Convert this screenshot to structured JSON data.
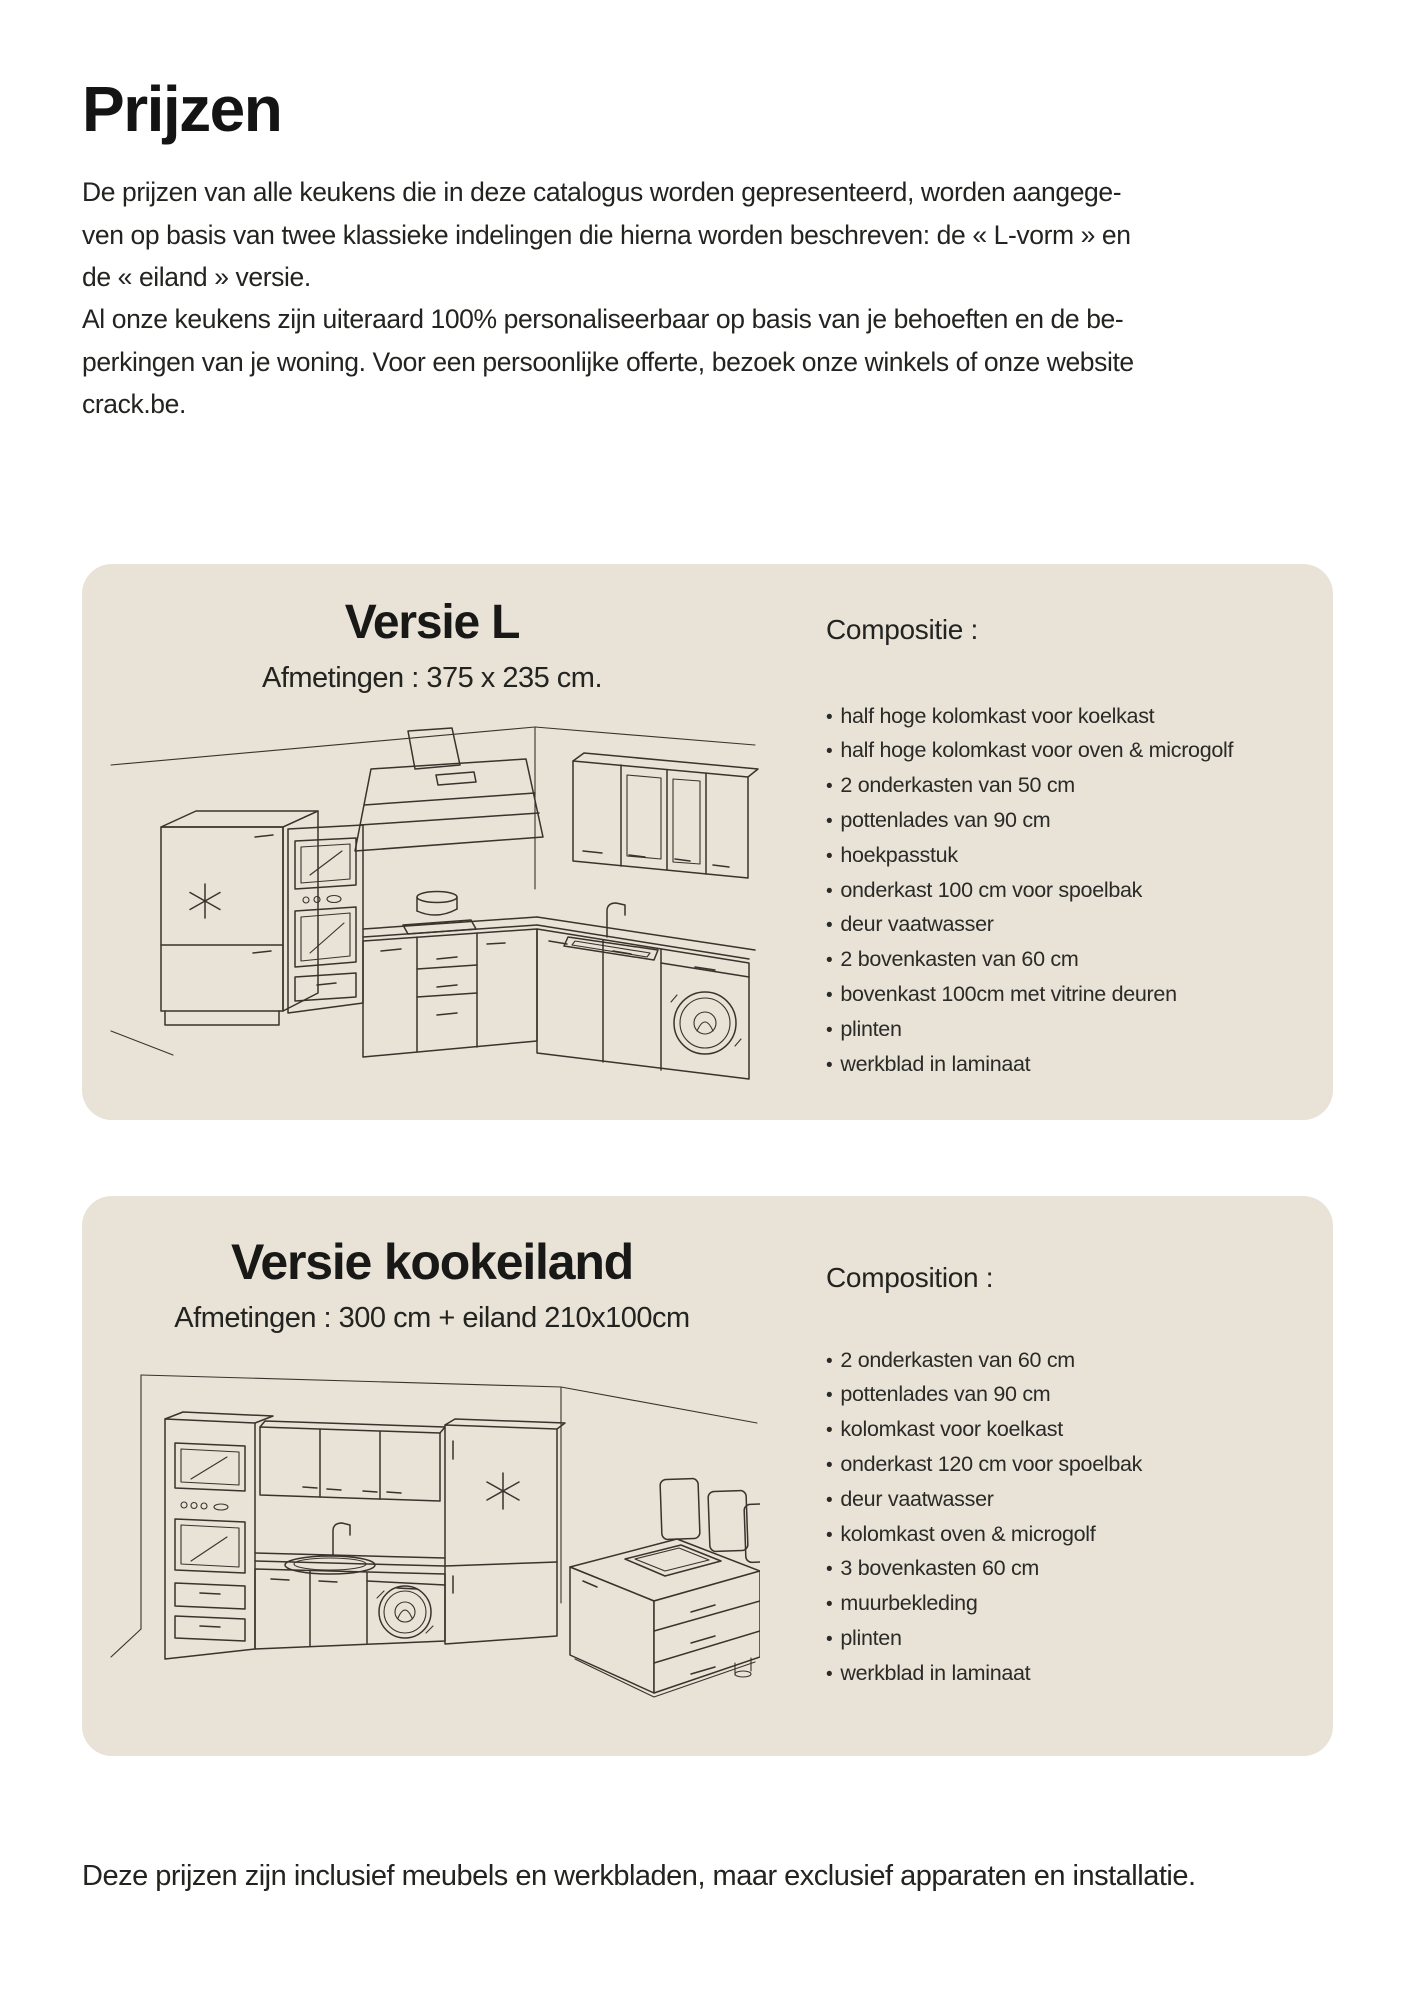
{
  "colors": {
    "card_bg": "#e8e2d7",
    "text": "#1d1d1b",
    "line_art": "#38332c"
  },
  "page": {
    "title": "Prijzen",
    "intro_lines": [
      "De prijzen van alle keukens die in deze catalogus worden gepresenteerd, worden aangege-",
      "ven op basis van twee klassieke indelingen die hierna worden beschreven: de « L-vorm » en",
      "de « eiland » versie.",
      "Al onze keukens zijn uiteraard 100% personaliseerbaar op basis van je behoeften en de be-",
      "perkingen van je woning. Voor een persoonlijke offerte, bezoek onze winkels of onze website",
      "crack.be."
    ],
    "footer": "Deze prijzen zijn inclusief meubels en werkbladen, maar exclusief apparaten en installatie."
  },
  "cards": [
    {
      "title": "Versie L",
      "dimensions": "Afmetingen : 375 x 235 cm.",
      "composition_label": "Compositie :",
      "items": [
        "half hoge kolomkast voor koelkast",
        "half hoge kolomkast voor oven & microgolf",
        "2 onderkasten van 50 cm",
        "pottenlades van 90 cm",
        "hoekpasstuk",
        "onderkast 100 cm voor spoelbak",
        "deur vaatwasser",
        "2 bovenkasten van 60 cm",
        "bovenkast 100cm met vitrine deuren",
        "plinten",
        "werkblad in laminaat"
      ]
    },
    {
      "title": "Versie kookeiland",
      "dimensions": "Afmetingen : 300 cm + eiland 210x100cm",
      "composition_label": "Composition :",
      "items": [
        "2 onderkasten van 60 cm",
        "pottenlades van 90 cm",
        "kolomkast voor koelkast",
        "onderkast 120 cm voor spoelbak",
        "deur vaatwasser",
        "kolomkast oven & microgolf",
        "3 bovenkasten 60 cm",
        "muurbekleding",
        "plinten",
        "werkblad in laminaat"
      ]
    }
  ]
}
